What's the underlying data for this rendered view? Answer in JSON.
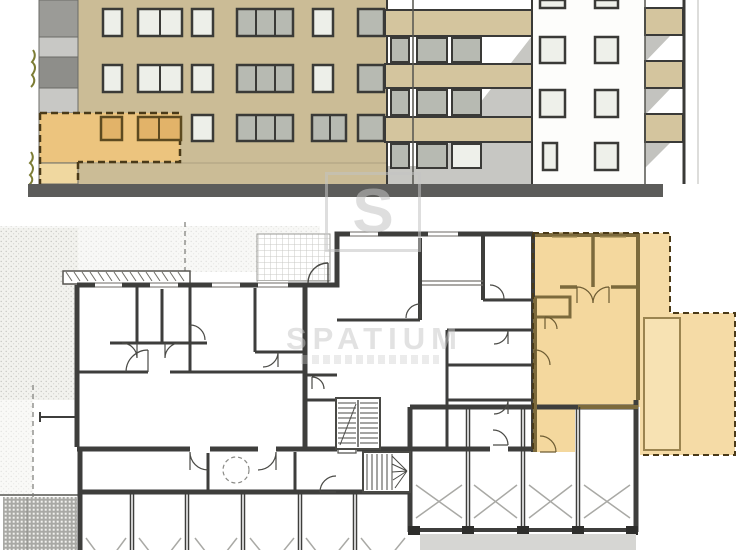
{
  "watermark": {
    "logo_letter": "S",
    "brand": "SPATIUM",
    "tagline_legible": false
  },
  "colors": {
    "facade_tan": "#cbbc96",
    "balcony_slab": "#d4c59e",
    "window_frame": "#3a3a37",
    "glass_light": "#edefe9",
    "glass_grey": "#b7bab2",
    "glass_orange": "#e2b369",
    "highlight_fill": "#ecc47e",
    "highlight_dash": "#4a3a18",
    "ground_bar": "#5c5c5a",
    "shadow_grey": "#c7c7c3",
    "plan_wall": "#3e3e3c",
    "plan_unit_fill": "#f4d89e",
    "plan_unit_deck_fill": "#f7e2b3",
    "plan_unit_wall": "#7c6a3c",
    "parking_mark_grey": "#a9a9a5",
    "plant_green": "#7c7c34"
  },
  "drawing": {
    "sheets": [
      {
        "name": "street-elevation"
      },
      {
        "name": "floor-plan"
      }
    ],
    "highlighted_unit_marker": "dashed-orange-outline"
  }
}
